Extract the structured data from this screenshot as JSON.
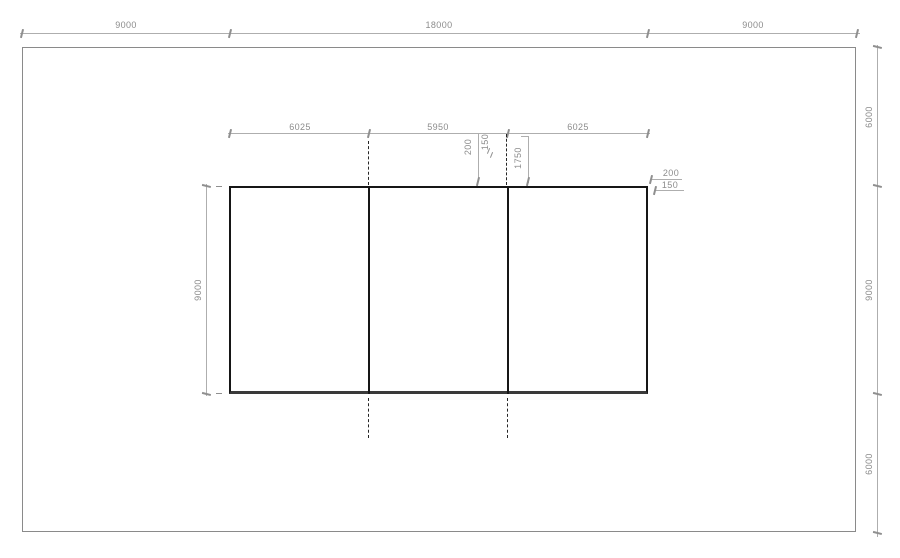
{
  "drawing": {
    "title": "dimensioned-plan",
    "colors": {
      "outline": "#161616",
      "boundary": "#8a8a8a",
      "dimension": "#8c8c8c"
    },
    "top_dim_chain": {
      "labels": [
        "9000",
        "18000",
        "9000"
      ]
    },
    "right_dim_chain": {
      "labels": [
        "6000",
        "9000",
        "6000"
      ]
    },
    "bay_dim_chain": {
      "labels": [
        "6025",
        "5950",
        "6025"
      ]
    },
    "left_dim": {
      "label": "9000"
    },
    "detail_dims": {
      "offset_200": "200",
      "offset_150": "150",
      "span_1750": "1750"
    },
    "corner_dims": {
      "offset_200": "200",
      "offset_150": "150"
    }
  }
}
